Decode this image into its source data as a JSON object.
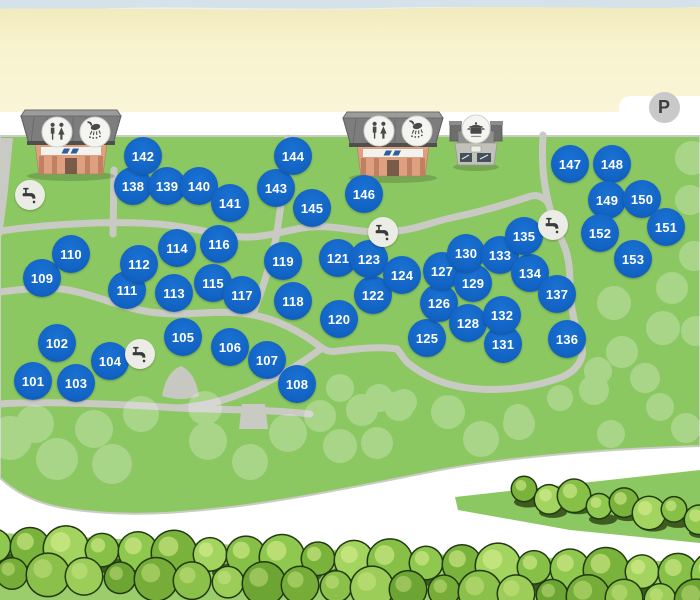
{
  "map_title": "campsite-pitch-map",
  "parking": {
    "label": "P",
    "x": 664,
    "y": 107
  },
  "colors": {
    "pitch_blue": "#1263c4",
    "field_green": "#8cc862",
    "sand": "#f8f2cd",
    "road_white": "#ffffff",
    "path_gray": "#c9cac3",
    "tree_outline": "#223a10"
  },
  "facilities": [
    {
      "type": "sanitary-block",
      "icons": [
        "toilet-icon",
        "shower-icon"
      ],
      "x": 71,
      "y": 140
    },
    {
      "type": "sanitary-block",
      "icons": [
        "toilet-icon",
        "shower-icon"
      ],
      "x": 393,
      "y": 142
    },
    {
      "type": "dishwashing-block",
      "icons": [
        "cooking-pot-icon"
      ],
      "x": 476,
      "y": 140
    }
  ],
  "water_taps": [
    {
      "x": 30,
      "y": 195
    },
    {
      "x": 140,
      "y": 354
    },
    {
      "x": 383,
      "y": 232
    },
    {
      "x": 553,
      "y": 225
    }
  ],
  "pitches": [
    {
      "n": "101",
      "x": 33,
      "y": 381
    },
    {
      "n": "102",
      "x": 57,
      "y": 343
    },
    {
      "n": "103",
      "x": 76,
      "y": 383
    },
    {
      "n": "104",
      "x": 110,
      "y": 361
    },
    {
      "n": "105",
      "x": 183,
      "y": 337
    },
    {
      "n": "106",
      "x": 230,
      "y": 347
    },
    {
      "n": "107",
      "x": 267,
      "y": 360
    },
    {
      "n": "108",
      "x": 297,
      "y": 384
    },
    {
      "n": "109",
      "x": 42,
      "y": 278
    },
    {
      "n": "110",
      "x": 71,
      "y": 254
    },
    {
      "n": "111",
      "x": 127,
      "y": 290
    },
    {
      "n": "112",
      "x": 139,
      "y": 264
    },
    {
      "n": "113",
      "x": 174,
      "y": 293
    },
    {
      "n": "114",
      "x": 177,
      "y": 248
    },
    {
      "n": "115",
      "x": 213,
      "y": 283
    },
    {
      "n": "116",
      "x": 219,
      "y": 244
    },
    {
      "n": "117",
      "x": 242,
      "y": 295
    },
    {
      "n": "118",
      "x": 293,
      "y": 301
    },
    {
      "n": "119",
      "x": 283,
      "y": 261
    },
    {
      "n": "120",
      "x": 339,
      "y": 319
    },
    {
      "n": "121",
      "x": 338,
      "y": 258
    },
    {
      "n": "122",
      "x": 373,
      "y": 295
    },
    {
      "n": "123",
      "x": 369,
      "y": 259
    },
    {
      "n": "124",
      "x": 402,
      "y": 275
    },
    {
      "n": "125",
      "x": 427,
      "y": 338
    },
    {
      "n": "126",
      "x": 439,
      "y": 303
    },
    {
      "n": "127",
      "x": 442,
      "y": 271
    },
    {
      "n": "128",
      "x": 468,
      "y": 323
    },
    {
      "n": "129",
      "x": 473,
      "y": 283
    },
    {
      "n": "130",
      "x": 466,
      "y": 253
    },
    {
      "n": "131",
      "x": 503,
      "y": 344
    },
    {
      "n": "132",
      "x": 502,
      "y": 315
    },
    {
      "n": "133",
      "x": 500,
      "y": 255
    },
    {
      "n": "134",
      "x": 530,
      "y": 273
    },
    {
      "n": "135",
      "x": 524,
      "y": 236
    },
    {
      "n": "136",
      "x": 567,
      "y": 339
    },
    {
      "n": "137",
      "x": 557,
      "y": 294
    },
    {
      "n": "138",
      "x": 133,
      "y": 186
    },
    {
      "n": "139",
      "x": 167,
      "y": 186
    },
    {
      "n": "140",
      "x": 199,
      "y": 186
    },
    {
      "n": "141",
      "x": 230,
      "y": 203
    },
    {
      "n": "142",
      "x": 143,
      "y": 156
    },
    {
      "n": "143",
      "x": 276,
      "y": 188
    },
    {
      "n": "144",
      "x": 293,
      "y": 156
    },
    {
      "n": "145",
      "x": 312,
      "y": 208
    },
    {
      "n": "146",
      "x": 364,
      "y": 194
    },
    {
      "n": "147",
      "x": 570,
      "y": 164
    },
    {
      "n": "148",
      "x": 612,
      "y": 164
    },
    {
      "n": "149",
      "x": 607,
      "y": 200
    },
    {
      "n": "150",
      "x": 642,
      "y": 199
    },
    {
      "n": "151",
      "x": 666,
      "y": 227
    },
    {
      "n": "152",
      "x": 600,
      "y": 233
    },
    {
      "n": "153",
      "x": 633,
      "y": 259
    }
  ]
}
